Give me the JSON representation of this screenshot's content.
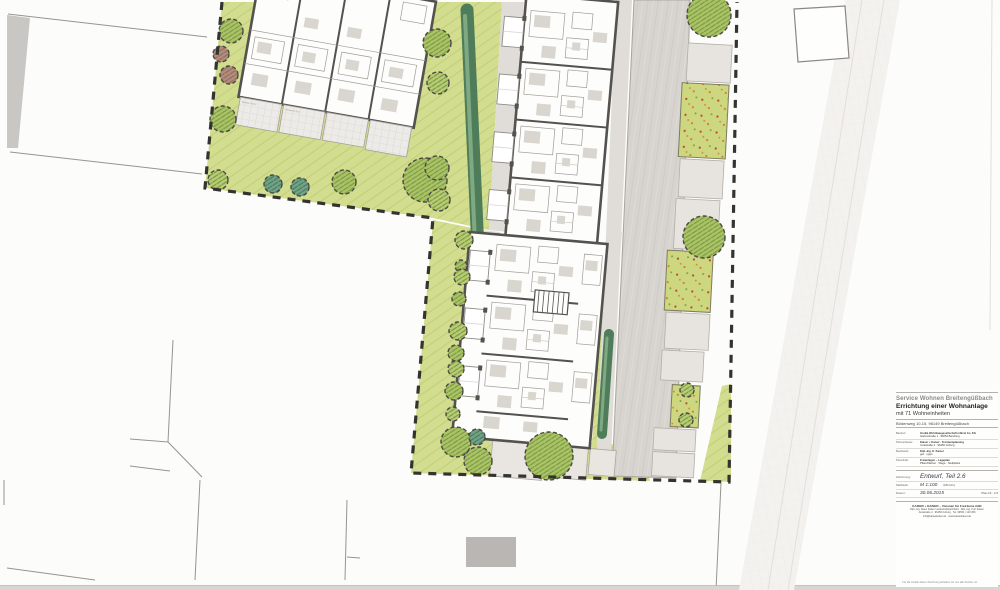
{
  "title_block": {
    "project_owner": "Service Wohnen Breitengüßbach",
    "project_title": "Errichtung einer Wohnanlage",
    "project_subtitle": "mit 71 Wohneinheiten",
    "project_address": "Bödenweg 10-15, 96149 Breitengüßbach",
    "info_rows": [
      {
        "label": "Bauherr:",
        "value": "GroBa Wohnbaugesellschaft mbH & Co. KG",
        "value2": "Gartenstraße 1 · 96052 Bamberg"
      },
      {
        "label": "Planverfasser:",
        "value": "Kaiser + Kaiser · Freiraumplanung",
        "value2": "Jurastraße 4 · 96450 Coburg"
      },
      {
        "label": "Bearbeitet:",
        "value": "Dipl.-Ing. K. Kaiser",
        "value2": "gez. / gepr."
      },
      {
        "label": "Planinhalt:",
        "value": "Freianlagen – Lageplan",
        "value2": "Pflanzflächen · Wege · Stellplätze"
      }
    ],
    "drawing_label": "Zeichnung:",
    "drawing_value": "Entwurf, Teil 2.6",
    "scale_label": "Maßstab:",
    "scale_value": "M 1:100",
    "format_value": "(DIN A1)",
    "date_label": "Datum:",
    "date_value": "30.06.2015",
    "plan_no_label": "Plan-Nr.:",
    "plan_no_value": "2.6",
    "firm_name": "KAISER + KAISER – Visionen für Freiräume GbR",
    "firm_line2": "Dipl.-Ing. Klaus Kaiser Landschaftsarchitekt · Dipl.-Ing. Kurt Kaiser",
    "firm_line3": "Jurastraße 4 · 96450 Coburg · Tel. 09561 / 123 456",
    "firm_line4": "info@kaiserkaiser.de · www.kaiserkaiser.de",
    "footnote": "Für die Inhalte dieser Zeichnung behalten wir uns alle Rechte vor."
  },
  "plan_labels": {
    "terrace_label_1": "Terrasse 12,5 m²",
    "terrace_label_2": "Terrasse 12,5 m²"
  },
  "colors": {
    "paper": "#fcfcfa",
    "lawn_green": "#d3dd8f",
    "lawn_hatch": "#c2d077",
    "planting_green": "#ccd780",
    "tree_green": "#abc465",
    "tree_green_light": "#b8cd74",
    "tree_teal": "#72a386",
    "tree_red_brown": "#b38c7b",
    "hedge_green": "#4f7d5a",
    "road_gray": "#d7d4d0",
    "paving_gray": "#e7e4e0",
    "wall_dark": "#54524e",
    "boundary_dark": "#35332f",
    "dot_red": "#bf4430",
    "dot_orange": "#d2802f",
    "dot_green": "#82a045"
  }
}
